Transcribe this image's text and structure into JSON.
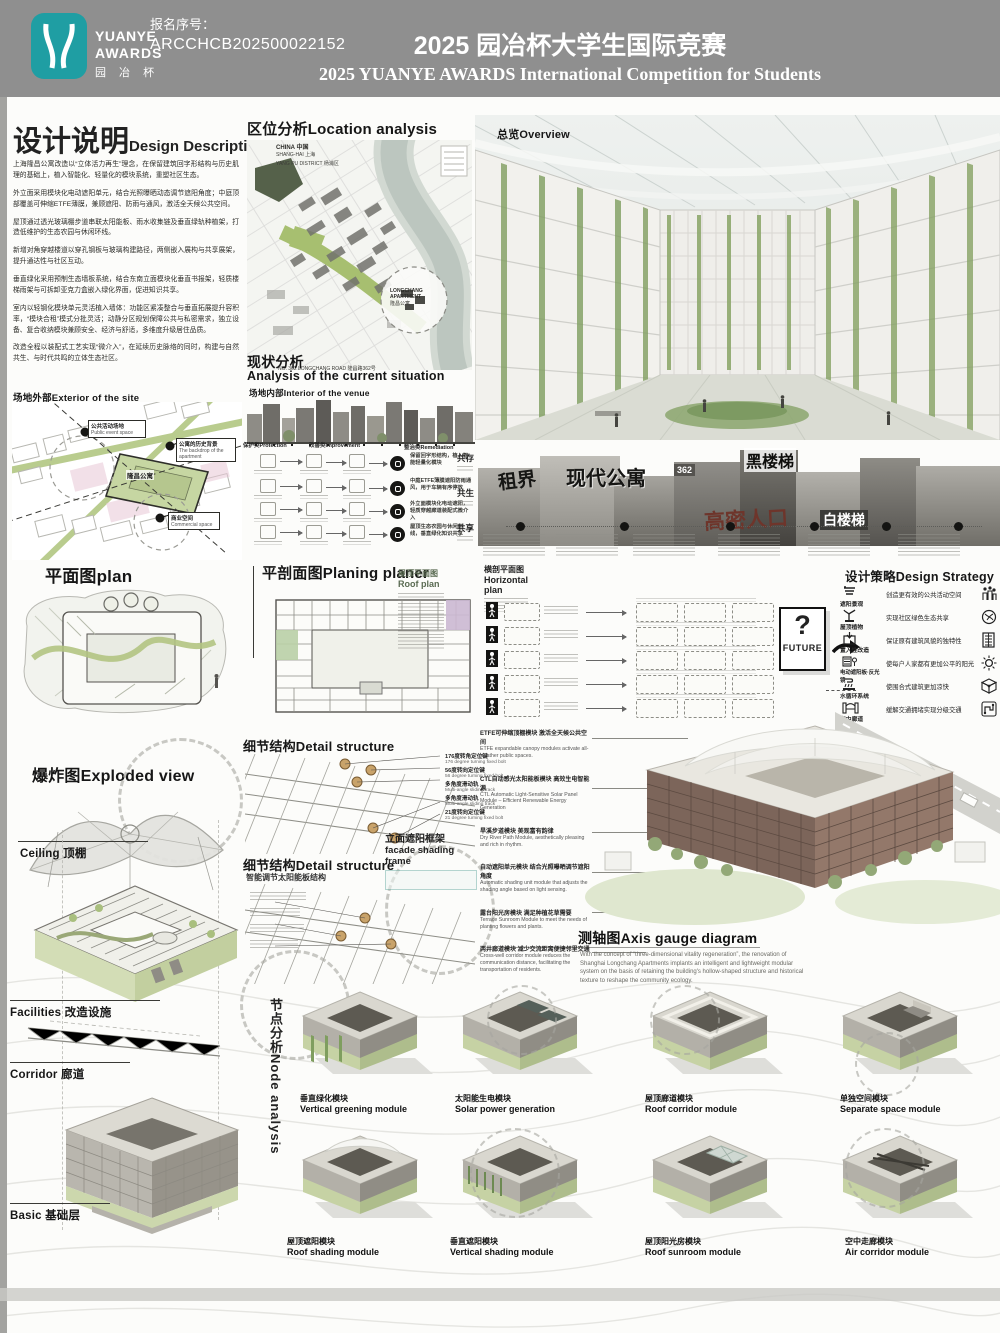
{
  "meta": {
    "header_gray": "#8f8f8f",
    "logo_teal": "#1f9ea3",
    "leaf_green": "#a9bf7e",
    "brick_brown": "#7c655a"
  },
  "header": {
    "reg_label": "报名序号：",
    "reg_number": "ARCCHCB202500022152",
    "title_cn": "2025 园冶杯大学生国际竞赛",
    "title_en": "2025 YUANYE AWARDS International Competition for  Students",
    "logo_l1": "YUANYE",
    "logo_l2": "AWARDS",
    "logo_l3": "园 冶 杯"
  },
  "design": {
    "title_cn": "设计说明",
    "title_en": "Design Description",
    "paras": [
      "上海隆昌公寓改造以“立体活力再生”理念，在保留建筑回字形结构与历史肌理的基础上，植入智能化、轻量化的模块系统，重塑社区生态。",
      "外立面采用模块化电动遮阳单元，结合光照曝晒动态调节遮阳角度；中庭顶部覆盖可伸缩ETFE薄膜，兼顾遮阳、防雨与通风，激活全天候公共空间。",
      "屋顶通过透光玻璃棚步道串联太阳能板、雨水收集链及垂直绿轨种植架，打造低维护的生态农园与休闲环线。",
      "新增对角穿越楼道以穿孔钢板与玻璃构建路径，两侧嵌入展构与共享展架，提升通达性与社区互动。",
      "垂直绿化采用预制生态墙板系统，结合东南立面模块化垂直书报架，轻质楼梯雨架与可拆卸亚克力盒嵌入绿化界面，促进知识共享。",
      "室内以轻钢化模块单元灵活植入墙体：功能区紧凑整合与垂直拓展提升容积率，“模块合租”模式分批灵活；动静分区规划保障公共与私密需求，独立设备、复合收纳模块兼顾安全、经济与舒适，多维度升级居住品质。",
      "改造全程以装配式工艺实现“微介入”，在延续历史脉络的同时，构建与自然共生、与时代共鸣的立体生态社区。"
    ]
  },
  "site_ext": {
    "label": "场地外部Exterior of the site",
    "building": "隆昌公寓",
    "c1_cn": "公共活动场地",
    "c1_en": "Public event space",
    "c2_cn": "公寓的历史背景",
    "c2_en": "The backdrop of the apartment",
    "c3_cn": "商业空间",
    "c3_en": "Commercial space"
  },
  "location": {
    "title": "区位分析Location analysis",
    "country": "CHINA 中国",
    "city": "SHANG-HAI 上海",
    "district": "YANG PU DISTRICT 杨浦区",
    "apartment_en": "LONGCHANG APARTMENT",
    "apartment_cn": "隆昌公寓",
    "road": "NO. 362 LONGCHANG ROAD 隆昌路362号"
  },
  "overview": {
    "label": "总览Overview"
  },
  "situation": {
    "title_cn": "现状分析",
    "title_en": "Analysis of the current situation",
    "interior": "场地内部Interior of the venue",
    "cats": [
      "保护类Protection",
      "改善类Improvement",
      "整治类Remediation"
    ],
    "commons": [
      "共存",
      "共生",
      "共享"
    ],
    "results": [
      "保留回字形结构，植入智能轻量化模块",
      "中庭ETFE薄膜遮阳防雨通风，用于车辆有序停放",
      "外立面模块化电动遮阳，轻质穿越廊道装配式微介入",
      "屋顶生态农园与休闲环线，垂直绿化知识共享"
    ]
  },
  "history": {
    "l1": "租界",
    "l2": "现代公寓",
    "l3": "黑楼梯",
    "l4": "高密人口",
    "l5": "白楼梯",
    "sign": "362"
  },
  "plans": {
    "plan": "平面图plan",
    "roof_cn": "屋顶平面图",
    "roof_en": "Roof plan",
    "section": "平剖面图Planing planer",
    "horiz_cn": "横剖平面图",
    "horiz_en": "Horizontal plan"
  },
  "future": {
    "q": "?",
    "label": "FUTURE"
  },
  "strategy": {
    "title": "设计策略Design Strategy",
    "items": [
      {
        "label": "遮阳景观",
        "desc": "创造更有效的公共活动空间"
      },
      {
        "label": "屋顶植物",
        "desc": "实现社区绿色生态共享"
      },
      {
        "label": "置入性改造",
        "desc": "保证原有建筑风貌的独特性"
      },
      {
        "label": "电动遮阳板·反光镜",
        "desc": "使每户人家都有更加公平的阳光"
      },
      {
        "label": "水循环系统",
        "desc": "使围合式建筑更加凉快"
      },
      {
        "label": "空中廊道",
        "desc": "缓解交通拥堵实现分级交通"
      }
    ]
  },
  "exploded": {
    "title": "爆炸图Exploded view",
    "ceiling": "Ceiling 顶棚",
    "facilities": "Facilities 改造设施",
    "corridor": "Corridor 廊道",
    "basic": "Basic 基础层"
  },
  "detail": {
    "title": "细节结构Detail structure",
    "smart": "智能调节太阳能板结构",
    "frame_cn": "立面遮阳框架",
    "frame_en": "facade shading frame",
    "callouts": [
      {
        "cn": "176度转角定位键",
        "en": "176 degree turning fixed bolt"
      },
      {
        "cn": "56度转向定位键",
        "en": "56 degree turning fixed bolt"
      },
      {
        "cn": "多角度滑动轨",
        "en": "Multi-angle sliding track"
      },
      {
        "cn": "多角度滑动轨",
        "en": "Multi-angle sliding track"
      },
      {
        "cn": "21度转向定位键",
        "en": "21 degree turning fixed bolt"
      }
    ]
  },
  "annos": [
    {
      "cn": "ETFE可伸缩顶棚模块 激活全天候公共空间",
      "en": "ETFE expandable canopy modules activate all-weather public spaces."
    },
    {
      "cn": "CTL自动感光太阳能板模块 高效生电智能源",
      "en": "CTL Automatic Light-Sensitive Solar Panel Module – Efficient Renewable Energy Generation"
    },
    {
      "cn": "旱溪步道模块 美观富有韵律",
      "en": "Dry River Path Module, aesthetically pleasing and rich in rhythm."
    },
    {
      "cn": "自动遮阳单元模块 结合光照曝晒调节遮阳角度",
      "en": "Automatic shading unit module that adjusts the shading angle based on light sensing."
    },
    {
      "cn": "露台阳光房模块 满足种植花草需要",
      "en": "Terrace Sunroom Module to meet the needs of planting flowers and plants."
    },
    {
      "cn": "两井廊道模块 减少交流距离便捷邻里交通",
      "en": "Cross-well corridor module reduces the communication distance, facilitating the transportation of residents."
    }
  ],
  "axis": {
    "title": "测轴图Axis gauge diagram",
    "body": "With the concept of “three-dimensional vitality regeneration”, the renovation of Shanghai Longchang Apartments implants an intelligent and lightweight modular system on the basis of retaining the building's hollow-shaped structure and historical texture to reshape the community ecology."
  },
  "nodes": {
    "vertical": "节点分析Node analysis",
    "modules": [
      {
        "cn": "垂直绿化模块",
        "en": "Vertical greening module"
      },
      {
        "cn": "太阳能生电模块",
        "en": "Solar power generation"
      },
      {
        "cn": "屋顶廊道模块",
        "en": "Roof corridor module"
      },
      {
        "cn": "单独空间模块",
        "en": "Separate space module"
      },
      {
        "cn": "屋顶遮阳模块",
        "en": "Roof shading module"
      },
      {
        "cn": "垂直遮阳模块",
        "en": "Vertical shading module"
      },
      {
        "cn": "屋顶阳光房模块",
        "en": "Roof sunroom module"
      },
      {
        "cn": "空中走廊模块",
        "en": "Air corridor module"
      }
    ]
  }
}
